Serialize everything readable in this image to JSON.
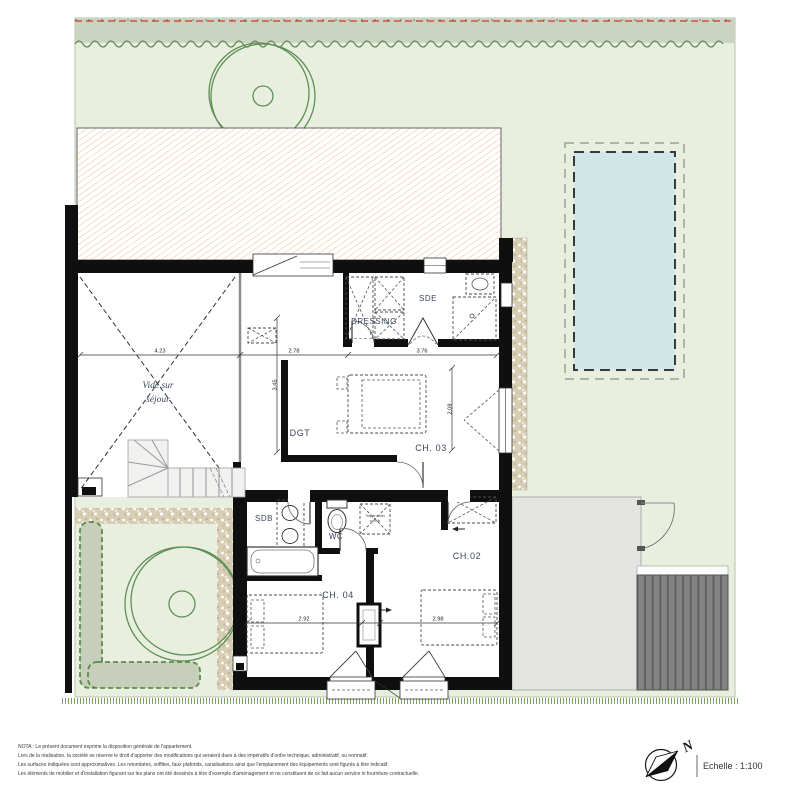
{
  "colors": {
    "lawn": "#e9efdf",
    "hedge_band": "#cbd3c2",
    "hedge_green": "#5d8b4d",
    "property_line_red": "#cf3a2a",
    "tree_green": "#5f8f55",
    "roof_hatch_line": "#efc39b",
    "wall_black": "#0f0f0f",
    "pool_water": "#cfe7e7",
    "gravel": "#d7cdb4",
    "terrace_gray": "#e3e3e1",
    "deck_gray": "#838383",
    "label_blue": "#3c4658"
  },
  "rooms": {
    "vide_line1": "Vide sur",
    "vide_line2": "séjour",
    "dressing": "DRESSING",
    "sde": "SDE",
    "dgt": "DGT",
    "ch03": "CH. 03",
    "sdb": "SDB",
    "wc": "WC",
    "ch04": "CH. 04",
    "ch02": "CH.02"
  },
  "annotations": {
    "trappe_line1": "Trappe accès",
    "trappe_line2": "comble"
  },
  "dimensions": {
    "vide_width": "4.23",
    "dgt_width": "2.78",
    "sde_width": "3.76",
    "ch04_width": "2.92",
    "ch02_width": "2.98",
    "left_height": "3.45",
    "ch03_height": "2.09"
  },
  "footer": {
    "nota_lines": [
      "NOTA : Le présent document exprime la disposition générale de l'appartement.",
      "Lors de la réalisation, la société se réserve le droit d'apporter des modifications qui seraient dues à des impératifs d'ordre technique, administratif, ou normatif.",
      "Les surfaces indiquées sont approximatives. Les retombées, soffites, faux plafonds, canalisations ainsi que l'emplacement des équipements sont figurés à titre indicatif.",
      "Les éléments de mobilier et d'installation figurant sur les plans ont été dessinés à titre d'exemple d'aménagement et ne constituent de ce fait aucun service ni fourniture contractuelle."
    ],
    "scale_label": "Echelle : 1:100",
    "north_letter": "N"
  }
}
